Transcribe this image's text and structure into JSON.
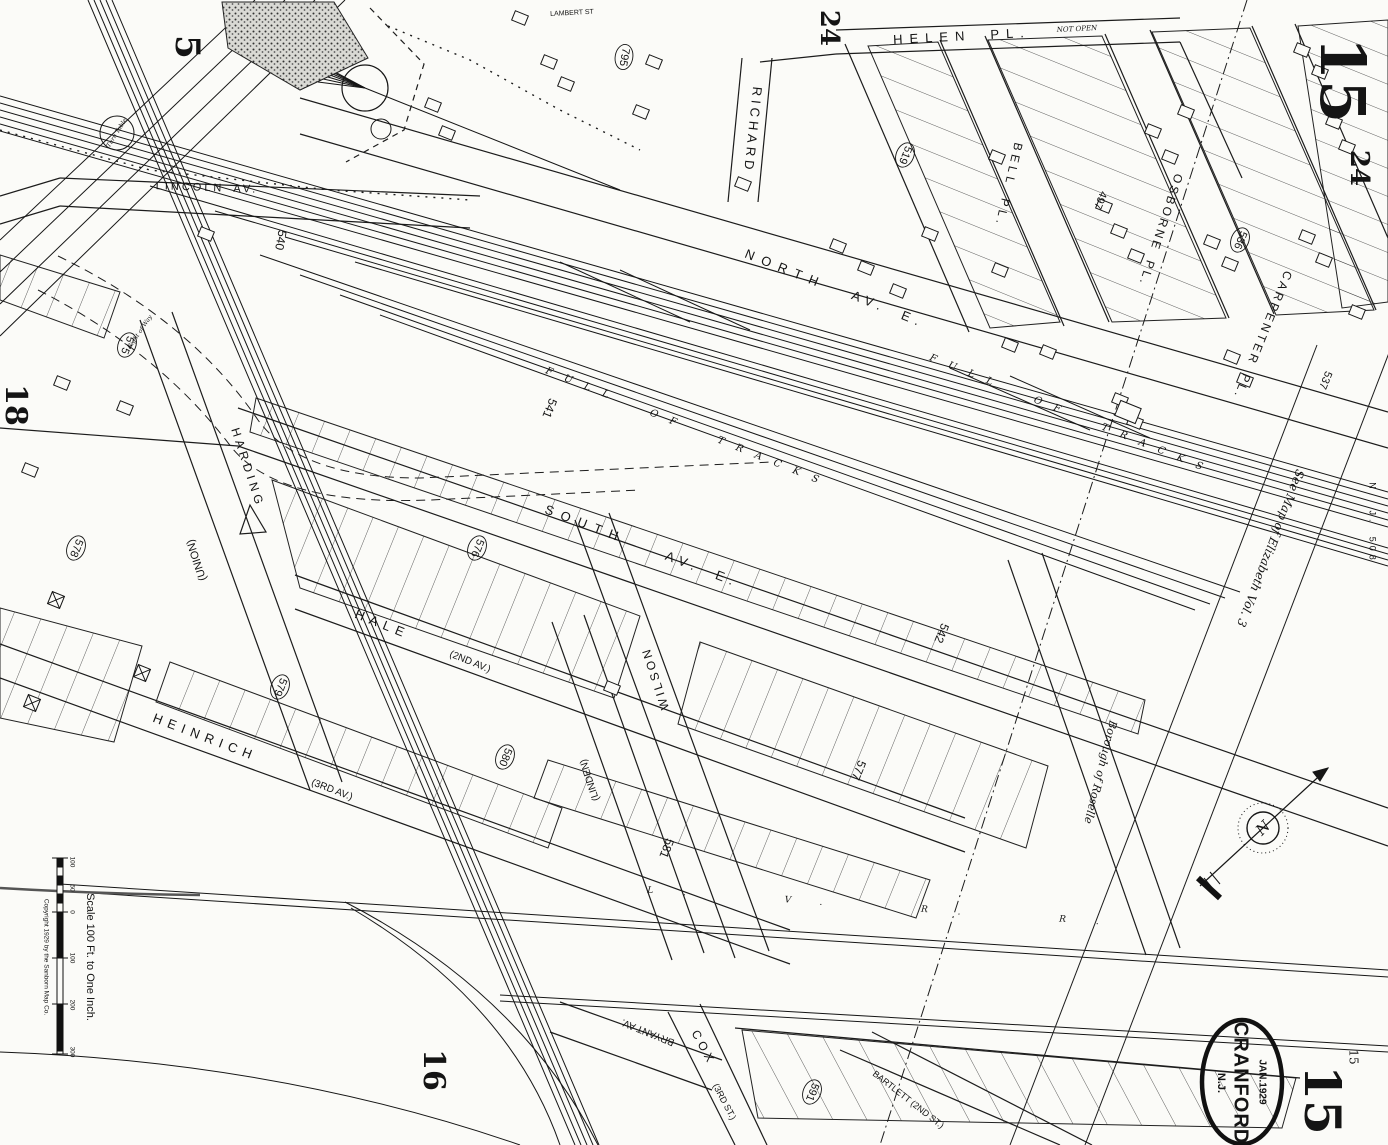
{
  "map_summary": {
    "stamp_city": "CRANFORD",
    "stamp_state": "N.J.",
    "stamp_date": "JAN.1929",
    "sheet_number": "15",
    "scale_caption": "Scale 100 Ft. to One Inch.",
    "copyright": "Copyright 1929 by the Sanborn Map Co.",
    "adjoining_sheets": [
      "5",
      "18",
      "16",
      "24",
      "24",
      "15"
    ],
    "boundary_note": "See Map of Elizabeth Vol. 3",
    "municipality_note": "Borough of Roselle",
    "railroads": [
      "FULL OF TRACKS",
      "L. V. R. R."
    ]
  },
  "streets": [
    "HELEN PL.",
    "LAMBERT ST",
    "RICHARD",
    "BELL PL.",
    "OSBORNE PL.",
    "CARPENTER PL.",
    "NORTH AV. E.",
    "SOUTH AV. E.",
    "LINCOLN AV.",
    "HALE (2ND AV.)",
    "HEINRICH (3RD AV.)",
    "HARDING (UNION)",
    "WILSON",
    "(LINDEN)",
    "BRYANT AV.",
    "COX (3RD ST.)",
    "BARTLETT (2ND ST.)"
  ],
  "block_numbers": [
    "795",
    "519",
    "497",
    "536",
    "537",
    "540",
    "541",
    "542",
    "575",
    "576",
    "577",
    "578",
    "579",
    "580",
    "581",
    "591"
  ],
  "scale_ticks": [
    "100",
    "50",
    "0",
    "100",
    "200",
    "300"
  ],
  "labels": [
    {
      "t": "HELEN  PL.",
      "x": 962,
      "y": 37,
      "r": -3,
      "s": 13,
      "ls": 7,
      "n": "street-helen-pl"
    },
    {
      "t": "NOT OPEN",
      "x": 1077,
      "y": 29,
      "r": -3,
      "s": 7,
      "i": 1,
      "n": "note-not-open"
    },
    {
      "t": "LAMBERT ST",
      "x": 572,
      "y": 13,
      "r": -3,
      "s": 7,
      "n": "street-lambert-st"
    },
    {
      "t": "RICHARD",
      "x": 752,
      "y": 130,
      "r": 96,
      "s": 13,
      "ls": 4,
      "n": "street-richard"
    },
    {
      "t": "BELL PL.",
      "x": 1008,
      "y": 185,
      "r": 103,
      "s": 12,
      "ls": 4,
      "n": "street-bell-pl"
    },
    {
      "t": "OSBORNE PL.",
      "x": 1160,
      "y": 230,
      "r": 108,
      "s": 12,
      "ls": 3,
      "n": "street-osborne-pl"
    },
    {
      "t": "CARPENTER PL.",
      "x": 1262,
      "y": 335,
      "r": 112,
      "s": 12,
      "ls": 3,
      "n": "street-carpenter-pl"
    },
    {
      "t": "NORTH",
      "x": 785,
      "y": 270,
      "r": 22,
      "s": 13,
      "ls": 8,
      "n": "street-north-av-word1"
    },
    {
      "t": "AV. E.",
      "x": 888,
      "y": 310,
      "r": 22,
      "s": 13,
      "ls": 6,
      "n": "street-north-av-word2"
    },
    {
      "t": "SOUTH",
      "x": 585,
      "y": 525,
      "r": 21,
      "s": 13,
      "ls": 8,
      "n": "street-south-av-word1"
    },
    {
      "t": "AV. E.",
      "x": 702,
      "y": 570,
      "r": 21,
      "s": 13,
      "ls": 6,
      "n": "street-south-av-word2"
    },
    {
      "t": "LINCOLN AV.",
      "x": 207,
      "y": 188,
      "r": 2,
      "s": 11,
      "ls": 3,
      "n": "street-lincoln-av"
    },
    {
      "t": "HALE",
      "x": 382,
      "y": 625,
      "r": 22,
      "s": 13,
      "ls": 6,
      "n": "street-hale"
    },
    {
      "t": "(2ND AV.)",
      "x": 470,
      "y": 662,
      "r": 22,
      "s": 10,
      "n": "street-hale-alias"
    },
    {
      "t": "HEINRICH",
      "x": 205,
      "y": 738,
      "r": 21,
      "s": 13,
      "ls": 6,
      "n": "street-heinrich"
    },
    {
      "t": "(3RD AV.)",
      "x": 332,
      "y": 790,
      "r": 21,
      "s": 10,
      "n": "street-heinrich-alias"
    },
    {
      "t": "HARDING",
      "x": 247,
      "y": 468,
      "r": 72,
      "s": 12,
      "ls": 4,
      "n": "street-harding"
    },
    {
      "t": "(UNION)",
      "x": 197,
      "y": 560,
      "r": -108,
      "s": 11,
      "n": "street-harding-alias"
    },
    {
      "t": "WILSON",
      "x": 656,
      "y": 678,
      "r": -108,
      "s": 12,
      "ls": 3,
      "n": "street-wilson"
    },
    {
      "t": "(LINDEN)",
      "x": 590,
      "y": 780,
      "r": -108,
      "s": 10,
      "n": "street-linden"
    },
    {
      "t": "BRYANT AV.",
      "x": 648,
      "y": 1032,
      "r": 202,
      "s": 10,
      "n": "street-bryant-av"
    },
    {
      "t": "COX",
      "x": 703,
      "y": 1048,
      "r": 62,
      "s": 12,
      "ls": 4,
      "n": "street-cox"
    },
    {
      "t": "(3RD ST.)",
      "x": 724,
      "y": 1102,
      "r": 62,
      "s": 9,
      "n": "street-cox-alias"
    },
    {
      "t": "BARTLETT (2ND ST.)",
      "x": 908,
      "y": 1100,
      "r": 38,
      "s": 9,
      "n": "street-bartlett"
    },
    {
      "t": "Borough of Roselle",
      "x": 1100,
      "y": 772,
      "r": 104,
      "s": 11,
      "i": 1,
      "n": "note-borough-of-roselle"
    },
    {
      "t": "See Map of Elizabeth Vol. 3",
      "x": 1270,
      "y": 548,
      "r": 111,
      "s": 12,
      "i": 1,
      "n": "note-see-map-elizabeth"
    },
    {
      "t": "N. J. 508",
      "x": 1372,
      "y": 523,
      "r": 90,
      "s": 9,
      "ls": 4,
      "n": "note-nj-508"
    },
    {
      "t": "Turn Table",
      "x": 117,
      "y": 133,
      "r": -58,
      "s": 6,
      "i": 1,
      "n": "note-turn-table"
    },
    {
      "t": "Right of Way",
      "x": 140,
      "y": 332,
      "r": -56,
      "s": 6,
      "i": 1,
      "n": "note-right-of-way"
    },
    {
      "t": "FULL OF TRACKS",
      "x": 688,
      "y": 428,
      "r": 22,
      "s": 10,
      "ls": 13,
      "i": 1,
      "cl": "#3d3d3d",
      "n": "note-full-of-tracks-1"
    },
    {
      "t": "FULL OF TRACKS",
      "x": 1072,
      "y": 415,
      "r": 22,
      "s": 10,
      "ls": 13,
      "i": 1,
      "cl": "#3d3d3d",
      "n": "note-full-of-tracks-2"
    },
    {
      "t": "L. V. R. R.",
      "x": 888,
      "y": 907,
      "r": 4,
      "s": 9,
      "ls": 30,
      "i": 1,
      "cl": "#3d3d3d",
      "n": "note-lvrr"
    },
    {
      "t": "795",
      "x": 624,
      "y": 57,
      "r": 100,
      "s": 11,
      "c": 1,
      "n": "block-795"
    },
    {
      "t": "519",
      "x": 905,
      "y": 155,
      "r": 112,
      "s": 11,
      "c": 1,
      "n": "block-519"
    },
    {
      "t": "497",
      "x": 1100,
      "y": 200,
      "r": 112,
      "s": 11,
      "n": "block-497"
    },
    {
      "t": "536",
      "x": 1240,
      "y": 240,
      "r": 112,
      "s": 11,
      "c": 1,
      "n": "block-536"
    },
    {
      "t": "537",
      "x": 1325,
      "y": 380,
      "r": 112,
      "s": 11,
      "n": "block-537"
    },
    {
      "t": "540",
      "x": 280,
      "y": 240,
      "r": 100,
      "s": 12,
      "n": "block-540"
    },
    {
      "t": "541",
      "x": 549,
      "y": 408,
      "r": 112,
      "s": 12,
      "n": "block-541"
    },
    {
      "t": "542",
      "x": 941,
      "y": 633,
      "r": 112,
      "s": 12,
      "n": "block-542"
    },
    {
      "t": "575",
      "x": 127,
      "y": 345,
      "r": 112,
      "s": 11,
      "c": 1,
      "n": "block-575"
    },
    {
      "t": "576",
      "x": 477,
      "y": 548,
      "r": 112,
      "s": 11,
      "c": 1,
      "n": "block-576"
    },
    {
      "t": "577",
      "x": 858,
      "y": 770,
      "r": 112,
      "s": 12,
      "n": "block-577"
    },
    {
      "t": "578",
      "x": 76,
      "y": 548,
      "r": 112,
      "s": 11,
      "c": 1,
      "n": "block-578"
    },
    {
      "t": "579",
      "x": 280,
      "y": 687,
      "r": 112,
      "s": 11,
      "c": 1,
      "n": "block-579"
    },
    {
      "t": "580",
      "x": 505,
      "y": 757,
      "r": 112,
      "s": 11,
      "c": 1,
      "n": "block-580"
    },
    {
      "t": "581",
      "x": 666,
      "y": 848,
      "r": 112,
      "s": 12,
      "n": "block-581"
    },
    {
      "t": "591",
      "x": 812,
      "y": 1092,
      "r": 112,
      "s": 11,
      "c": 1,
      "n": "block-591"
    },
    {
      "t": "5",
      "x": 185,
      "y": 47,
      "r": 90,
      "s": 34,
      "f": 1,
      "w": 1,
      "n": "adjoining-sheet-5"
    },
    {
      "t": "24",
      "x": 828,
      "y": 28,
      "r": 90,
      "s": 26,
      "f": 1,
      "w": 1,
      "n": "adjoining-sheet-24-top"
    },
    {
      "t": "24",
      "x": 1358,
      "y": 168,
      "r": 90,
      "s": 26,
      "f": 1,
      "w": 1,
      "n": "adjoining-sheet-24-right"
    },
    {
      "t": "15",
      "x": 1337,
      "y": 80,
      "r": 90,
      "s": 62,
      "f": 1,
      "w": 1,
      "n": "sheet-number-top"
    },
    {
      "t": "18",
      "x": 14,
      "y": 405,
      "r": 90,
      "s": 30,
      "f": 1,
      "w": 1,
      "n": "adjoining-sheet-18"
    },
    {
      "t": "16",
      "x": 432,
      "y": 1070,
      "r": 90,
      "s": 30,
      "f": 1,
      "w": 1,
      "n": "adjoining-sheet-16"
    },
    {
      "t": "15",
      "x": 1318,
      "y": 1100,
      "r": 90,
      "s": 50,
      "f": 1,
      "w": 1,
      "n": "sheet-number-bottom"
    },
    {
      "t": "15",
      "x": 1353,
      "y": 1057,
      "r": 90,
      "s": 12,
      "f": 1,
      "n": "sheet-number-bottom-small"
    },
    {
      "t": "Scale 100 Ft. to One Inch.",
      "x": 90,
      "y": 957,
      "r": 90,
      "s": 11,
      "n": "scale-caption"
    },
    {
      "t": "Copyright 1929 by the Sanborn Map Co.",
      "x": 46,
      "y": 957,
      "r": 90,
      "s": 6.5,
      "cl": "#444",
      "n": "copyright-note"
    },
    {
      "t": "100",
      "x": 72,
      "y": 862,
      "r": 90,
      "s": 6.5,
      "n": "scale-tick-100a"
    },
    {
      "t": "50",
      "x": 72,
      "y": 888,
      "r": 90,
      "s": 6.5,
      "n": "scale-tick-50"
    },
    {
      "t": "0",
      "x": 72,
      "y": 912,
      "r": 90,
      "s": 6.5,
      "n": "scale-tick-0"
    },
    {
      "t": "100",
      "x": 72,
      "y": 958,
      "r": 90,
      "s": 6.5,
      "n": "scale-tick-100b"
    },
    {
      "t": "200",
      "x": 72,
      "y": 1005,
      "r": 90,
      "s": 6.5,
      "n": "scale-tick-200"
    },
    {
      "t": "300",
      "x": 72,
      "y": 1052,
      "r": 90,
      "s": 6.5,
      "n": "scale-tick-300"
    },
    {
      "t": "JAN.1929",
      "x": 1262,
      "y": 1082,
      "r": 90,
      "s": 10,
      "w": 1,
      "n": "stamp-date"
    },
    {
      "t": "CRANFORD",
      "x": 1240,
      "y": 1083,
      "r": 90,
      "s": 20,
      "w": 1,
      "ls": 1,
      "n": "stamp-city"
    },
    {
      "t": "N.J.",
      "x": 1221,
      "y": 1083,
      "r": 90,
      "s": 11,
      "w": 1,
      "n": "stamp-state"
    }
  ]
}
